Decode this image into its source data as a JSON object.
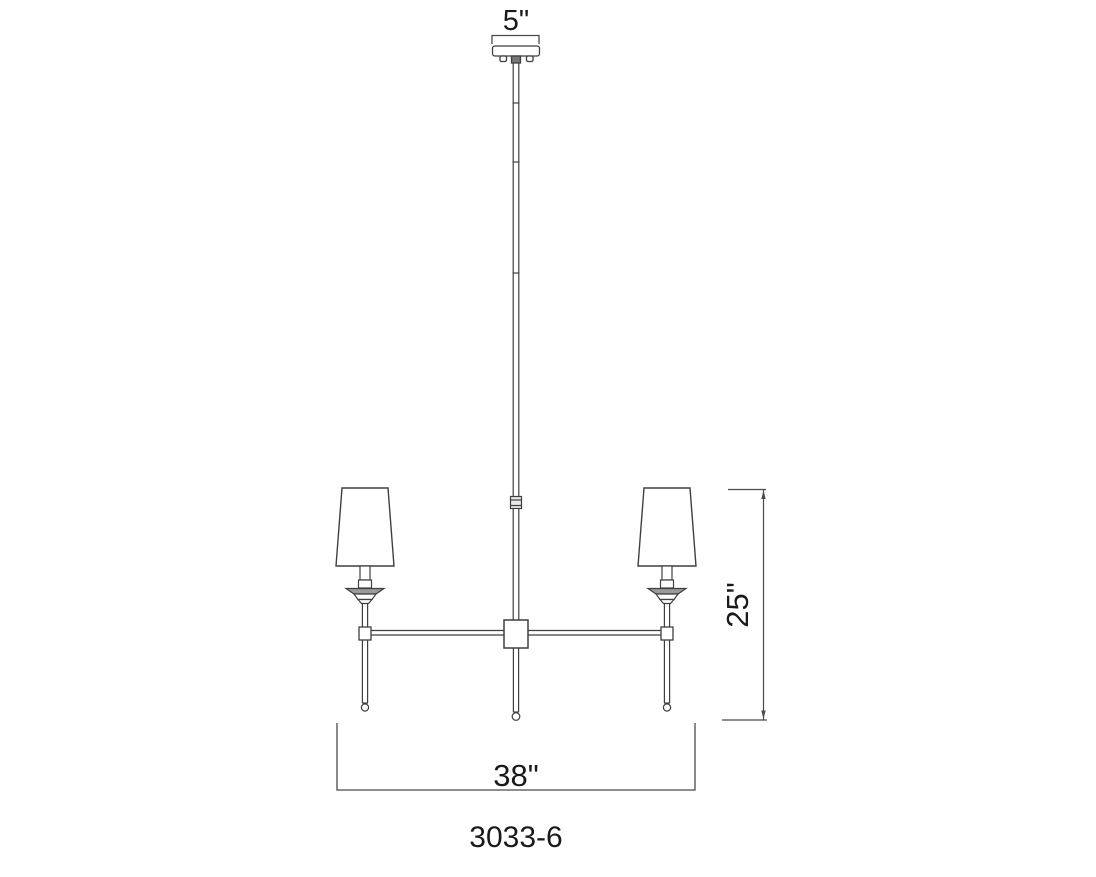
{
  "drawing": {
    "title": "chandelier elevation dimension drawing",
    "model_number": "3033-6",
    "dimensions": {
      "canopy_width": "5\"",
      "fixture_height": "25\"",
      "fixture_width": "38\""
    },
    "parts": {
      "canopy": "ceiling canopy",
      "stem": "down rod with couplers",
      "hub": "center body hub",
      "arms": "horizontal arms",
      "shades": "tapered fabric shades",
      "bobeche": "candle bobeche",
      "finials": "drop finials"
    },
    "colors": {
      "line": "#3f3f3f",
      "dim_line": "#4a4a4a",
      "text": "#1a1a1a",
      "bobeche_fill": "#9a9a9a",
      "coupler_fill": "#e8e8e8",
      "background": "#ffffff"
    }
  }
}
